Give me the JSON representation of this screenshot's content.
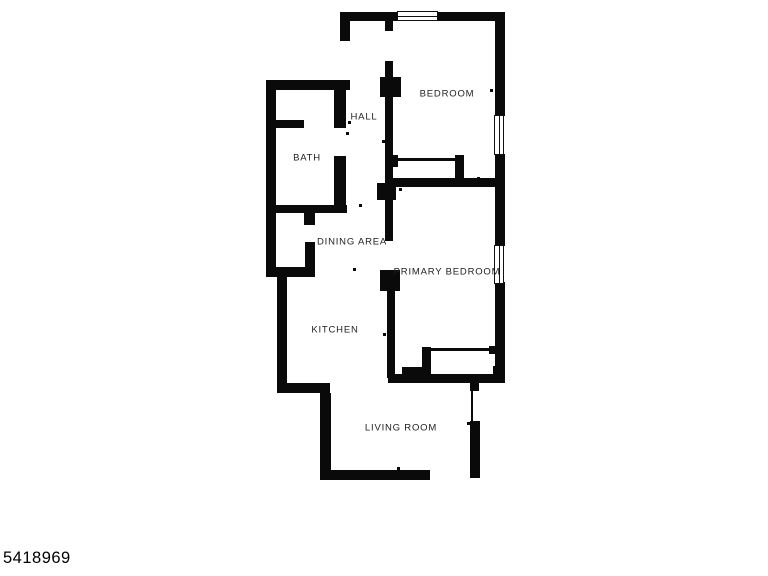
{
  "canvas": {
    "width": 768,
    "height": 576,
    "background": "#ffffff"
  },
  "colors": {
    "wall": "#0a0a0a",
    "label": "#222222",
    "window_border": "#111111",
    "window_fill": "#ffffff"
  },
  "listing_id": "5418969",
  "floorplan": {
    "rooms": [
      {
        "label": "BEDROOM",
        "cx": 447,
        "cy": 94
      },
      {
        "label": "HALL",
        "cx": 364,
        "cy": 117
      },
      {
        "label": "BATH",
        "cx": 307,
        "cy": 158
      },
      {
        "label": "DINING AREA",
        "cx": 352,
        "cy": 242
      },
      {
        "label": "PRIMARY BEDROOM",
        "cx": 447,
        "cy": 272
      },
      {
        "label": "KITCHEN",
        "cx": 335,
        "cy": 330
      },
      {
        "label": "LIVING ROOM",
        "cx": 401,
        "cy": 428
      }
    ],
    "walls": [
      {
        "name": "top-wall-left",
        "rect": [
          340,
          12,
          58,
          9
        ]
      },
      {
        "name": "top-wall-right",
        "rect": [
          437,
          12,
          68,
          9
        ]
      },
      {
        "name": "upper-left-corner-wall",
        "rect": [
          340,
          12,
          10,
          29
        ]
      },
      {
        "name": "right-wall-upper",
        "rect": [
          495,
          12,
          10,
          104
        ]
      },
      {
        "name": "right-wall-middle",
        "rect": [
          495,
          154,
          10,
          92
        ]
      },
      {
        "name": "right-wall-lower",
        "rect": [
          495,
          282,
          10,
          101
        ]
      },
      {
        "name": "hall-bedroom-wall-stub",
        "rect": [
          385,
          19,
          8,
          12
        ]
      },
      {
        "name": "hall-bedroom-wall-upper",
        "rect": [
          385,
          61,
          8,
          17
        ]
      },
      {
        "name": "hall-wall-block-upper",
        "rect": [
          380,
          77,
          21,
          20
        ]
      },
      {
        "name": "hall-bedroom-wall-main",
        "rect": [
          385,
          97,
          8,
          87
        ]
      },
      {
        "name": "hall-wall-junction",
        "rect": [
          377,
          183,
          19,
          17
        ]
      },
      {
        "name": "dining-wall-upper",
        "rect": [
          385,
          200,
          8,
          41
        ]
      },
      {
        "name": "dining-wall-block",
        "rect": [
          380,
          270,
          20,
          21
        ]
      },
      {
        "name": "kitchen-primary-wall",
        "rect": [
          387,
          291,
          8,
          87
        ]
      },
      {
        "name": "bedroom-divider-wall",
        "rect": [
          385,
          178,
          119,
          9
        ]
      },
      {
        "name": "bedroom-closet-stub-left",
        "rect": [
          390,
          155,
          8,
          12
        ]
      },
      {
        "name": "bedroom-closet-wall-right",
        "rect": [
          455,
          155,
          9,
          29
        ]
      },
      {
        "name": "bath-top-wall",
        "rect": [
          266,
          80,
          84,
          10
        ]
      },
      {
        "name": "bath-left-wall",
        "rect": [
          266,
          80,
          10,
          197
        ]
      },
      {
        "name": "bath-inner-wall",
        "rect": [
          268,
          120,
          36,
          8
        ]
      },
      {
        "name": "bath-hall-wall-upper",
        "rect": [
          334,
          88,
          12,
          40
        ]
      },
      {
        "name": "bath-hall-wall-lower",
        "rect": [
          334,
          156,
          12,
          56
        ]
      },
      {
        "name": "bath-bottom-wall",
        "rect": [
          266,
          205,
          81,
          8
        ]
      },
      {
        "name": "alcove-right-wall-upper",
        "rect": [
          304,
          213,
          11,
          12
        ]
      },
      {
        "name": "alcove-right-wall-lower",
        "rect": [
          305,
          242,
          10,
          35
        ]
      },
      {
        "name": "alcove-bottom-wall",
        "rect": [
          266,
          267,
          48,
          10
        ]
      },
      {
        "name": "kitchen-left-wall",
        "rect": [
          277,
          277,
          10,
          111
        ]
      },
      {
        "name": "kitchen-jog-wall",
        "rect": [
          277,
          383,
          53,
          10
        ]
      },
      {
        "name": "living-left-wall",
        "rect": [
          320,
          393,
          11,
          87
        ]
      },
      {
        "name": "living-bottom-wall",
        "rect": [
          321,
          470,
          109,
          10
        ]
      },
      {
        "name": "living-right-wall",
        "rect": [
          470,
          421,
          10,
          57
        ]
      },
      {
        "name": "living-right-stub",
        "rect": [
          470,
          383,
          9,
          8
        ]
      },
      {
        "name": "primary-bottom-wall",
        "rect": [
          388,
          374,
          116,
          9
        ]
      },
      {
        "name": "primary-step-block",
        "rect": [
          402,
          367,
          21,
          16
        ]
      },
      {
        "name": "primary-corner-block",
        "rect": [
          493,
          366,
          11,
          17
        ]
      },
      {
        "name": "primary-closet-wall-left",
        "rect": [
          422,
          347,
          9,
          31
        ]
      },
      {
        "name": "primary-closet-stub-right",
        "rect": [
          489,
          346,
          7,
          8
        ]
      }
    ],
    "windows": [
      {
        "name": "bedroom-top-window",
        "rect": [
          397,
          11,
          41,
          10
        ],
        "dir": "h"
      },
      {
        "name": "bedroom-right-window",
        "rect": [
          494,
          115,
          10,
          40
        ],
        "dir": "v"
      },
      {
        "name": "primary-right-window",
        "rect": [
          494,
          245,
          10,
          39
        ],
        "dir": "v"
      }
    ],
    "door_lines": [
      {
        "name": "bedroom-closet-door",
        "rect": [
          397,
          158,
          59,
          3
        ]
      },
      {
        "name": "primary-closet-door",
        "rect": [
          431,
          348,
          59,
          3
        ]
      },
      {
        "name": "living-right-opening",
        "rect": [
          471,
          391,
          2,
          31
        ]
      }
    ],
    "door_dots": [
      [
        362,
        18
      ],
      [
        490,
        16
      ],
      [
        490,
        89
      ],
      [
        382,
        140
      ],
      [
        348,
        121
      ],
      [
        346,
        132
      ],
      [
        306,
        383
      ],
      [
        282,
        334
      ],
      [
        359,
        204
      ],
      [
        353,
        268
      ],
      [
        397,
        467
      ],
      [
        467,
        422
      ],
      [
        477,
        177
      ],
      [
        399,
        188
      ],
      [
        383,
        333
      ]
    ]
  }
}
